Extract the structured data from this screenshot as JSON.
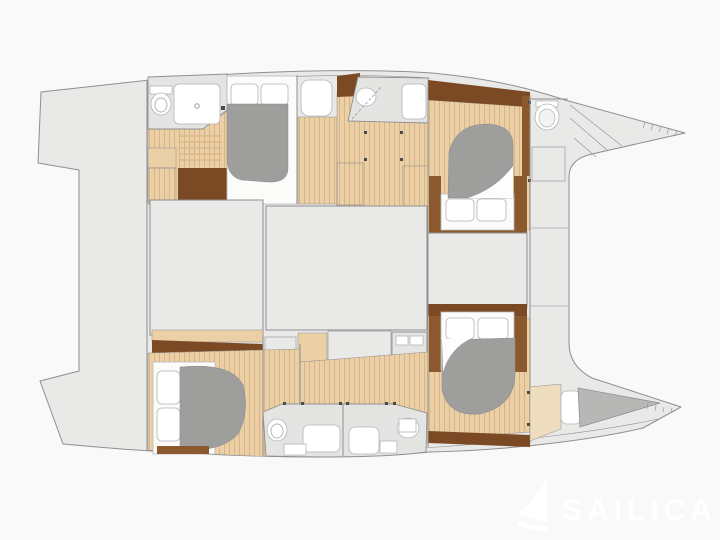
{
  "title": "Catamaran sailing yacht deck plan",
  "watermark": {
    "text": "SAILICA",
    "logo": "sail-icon"
  },
  "colors": {
    "background": "#f9f9f9",
    "deck": "#e9e9e8",
    "outline": "#8f8f8f",
    "fixture": "#e4e4e3",
    "wood_floor": "#ebcfa6",
    "wood_plank_line": "#d9b584",
    "wood_dark": "#7b4a24",
    "wood_mid": "#8a5a2e",
    "bed_duvet": "#9e9e9d",
    "berth_gray": "#b7b7b6",
    "mattress": "#fbfbfa",
    "hatch_bg": "#e7e7e6",
    "hatch_line": "#a0a0a0",
    "tan_light": "#eedcbe",
    "watermark": "#ffffff"
  },
  "floorplan": {
    "type": "catamaran-deck-plan",
    "orientation": "bow-right",
    "regions": [
      {
        "name": "port-transom",
        "kind": "swim-platform"
      },
      {
        "name": "starboard-transom",
        "kind": "swim-platform"
      },
      {
        "name": "aft-deck",
        "kind": "deck"
      },
      {
        "name": "saloon-aft",
        "kind": "saloon"
      },
      {
        "name": "saloon-forward",
        "kind": "saloon"
      },
      {
        "name": "forward-cockpit",
        "kind": "deck"
      },
      {
        "name": "trampoline",
        "kind": "open-area"
      },
      {
        "name": "port-bow",
        "kind": "bow"
      },
      {
        "name": "starboard-bow",
        "kind": "bow"
      },
      {
        "name": "port-aft-cabin",
        "kind": "double-cabin"
      },
      {
        "name": "port-aft-bathroom",
        "kind": "bathroom"
      },
      {
        "name": "port-mid-bathroom",
        "kind": "bathroom"
      },
      {
        "name": "port-forward-cabin",
        "kind": "double-cabin"
      },
      {
        "name": "port-forward-wc",
        "kind": "bathroom"
      },
      {
        "name": "starboard-aft-cabin",
        "kind": "double-cabin"
      },
      {
        "name": "starboard-bathroom-port-side",
        "kind": "bathroom"
      },
      {
        "name": "starboard-bathroom-stbd-side",
        "kind": "bathroom"
      },
      {
        "name": "starboard-forward-cabin",
        "kind": "double-cabin"
      },
      {
        "name": "starboard-forepeak-berth",
        "kind": "berth"
      },
      {
        "name": "galley-cabinets",
        "kind": "cabinetry"
      },
      {
        "name": "wardrobes",
        "kind": "cabinetry"
      },
      {
        "name": "companionway-steps",
        "kind": "stairs"
      }
    ]
  }
}
